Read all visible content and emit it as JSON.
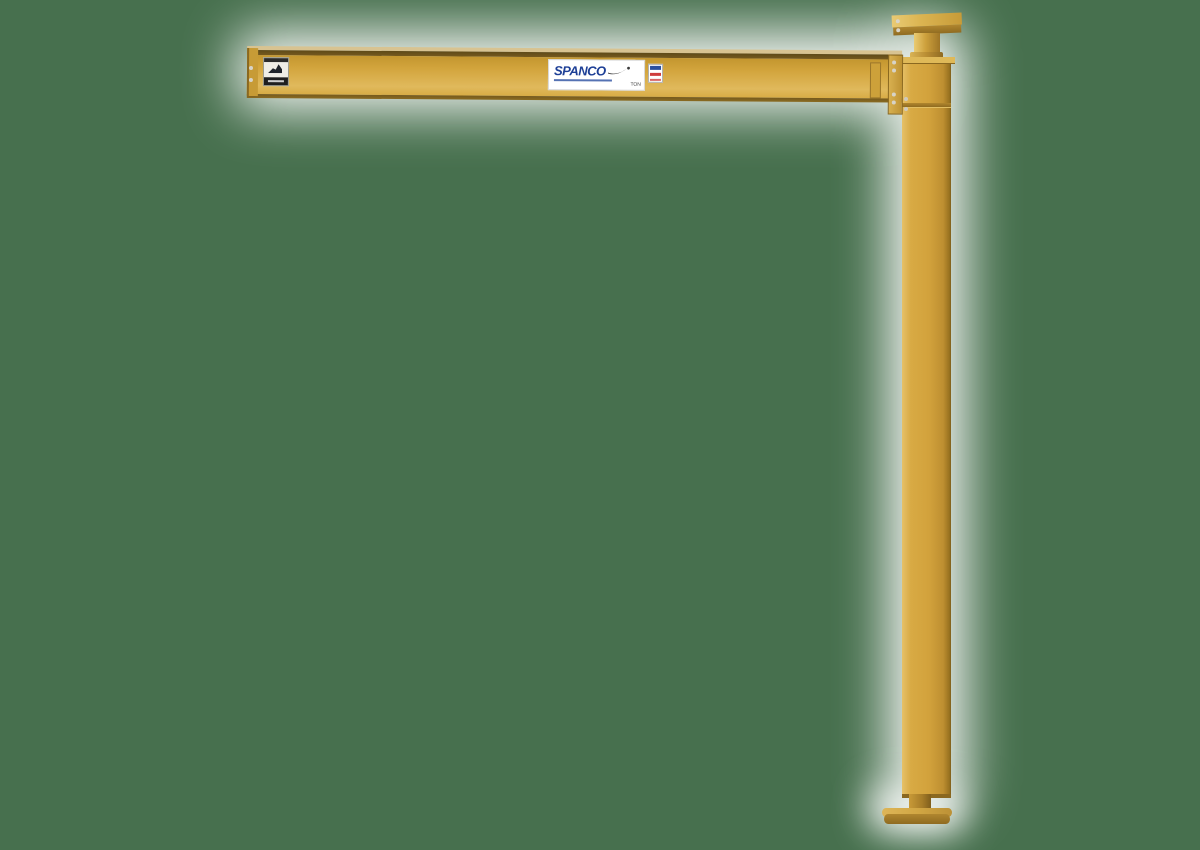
{
  "image": {
    "type": "product-photo",
    "subject": "Yellow free-standing full-cantilever jib crane: horizontal boom bolted to vertical mast with top pivot plate and floor base plate",
    "background_color": "#47704E",
    "crane_color": "#D2A23C",
    "halo_color": "#FFFFFF"
  },
  "labels": {
    "brand": {
      "text": "SPANCO",
      "color": "#1D3F96",
      "capacity_text": "TON"
    },
    "warning_sticker": {
      "name": "warning-sticker",
      "colors": [
        "#2B2B2B",
        "#EFEDE6",
        "#1F1F1F"
      ]
    },
    "origin_sticker": {
      "name": "origin-sticker",
      "colors": [
        "#2A4FA0",
        "#CF3D3D",
        "#FFFFFF"
      ]
    }
  }
}
